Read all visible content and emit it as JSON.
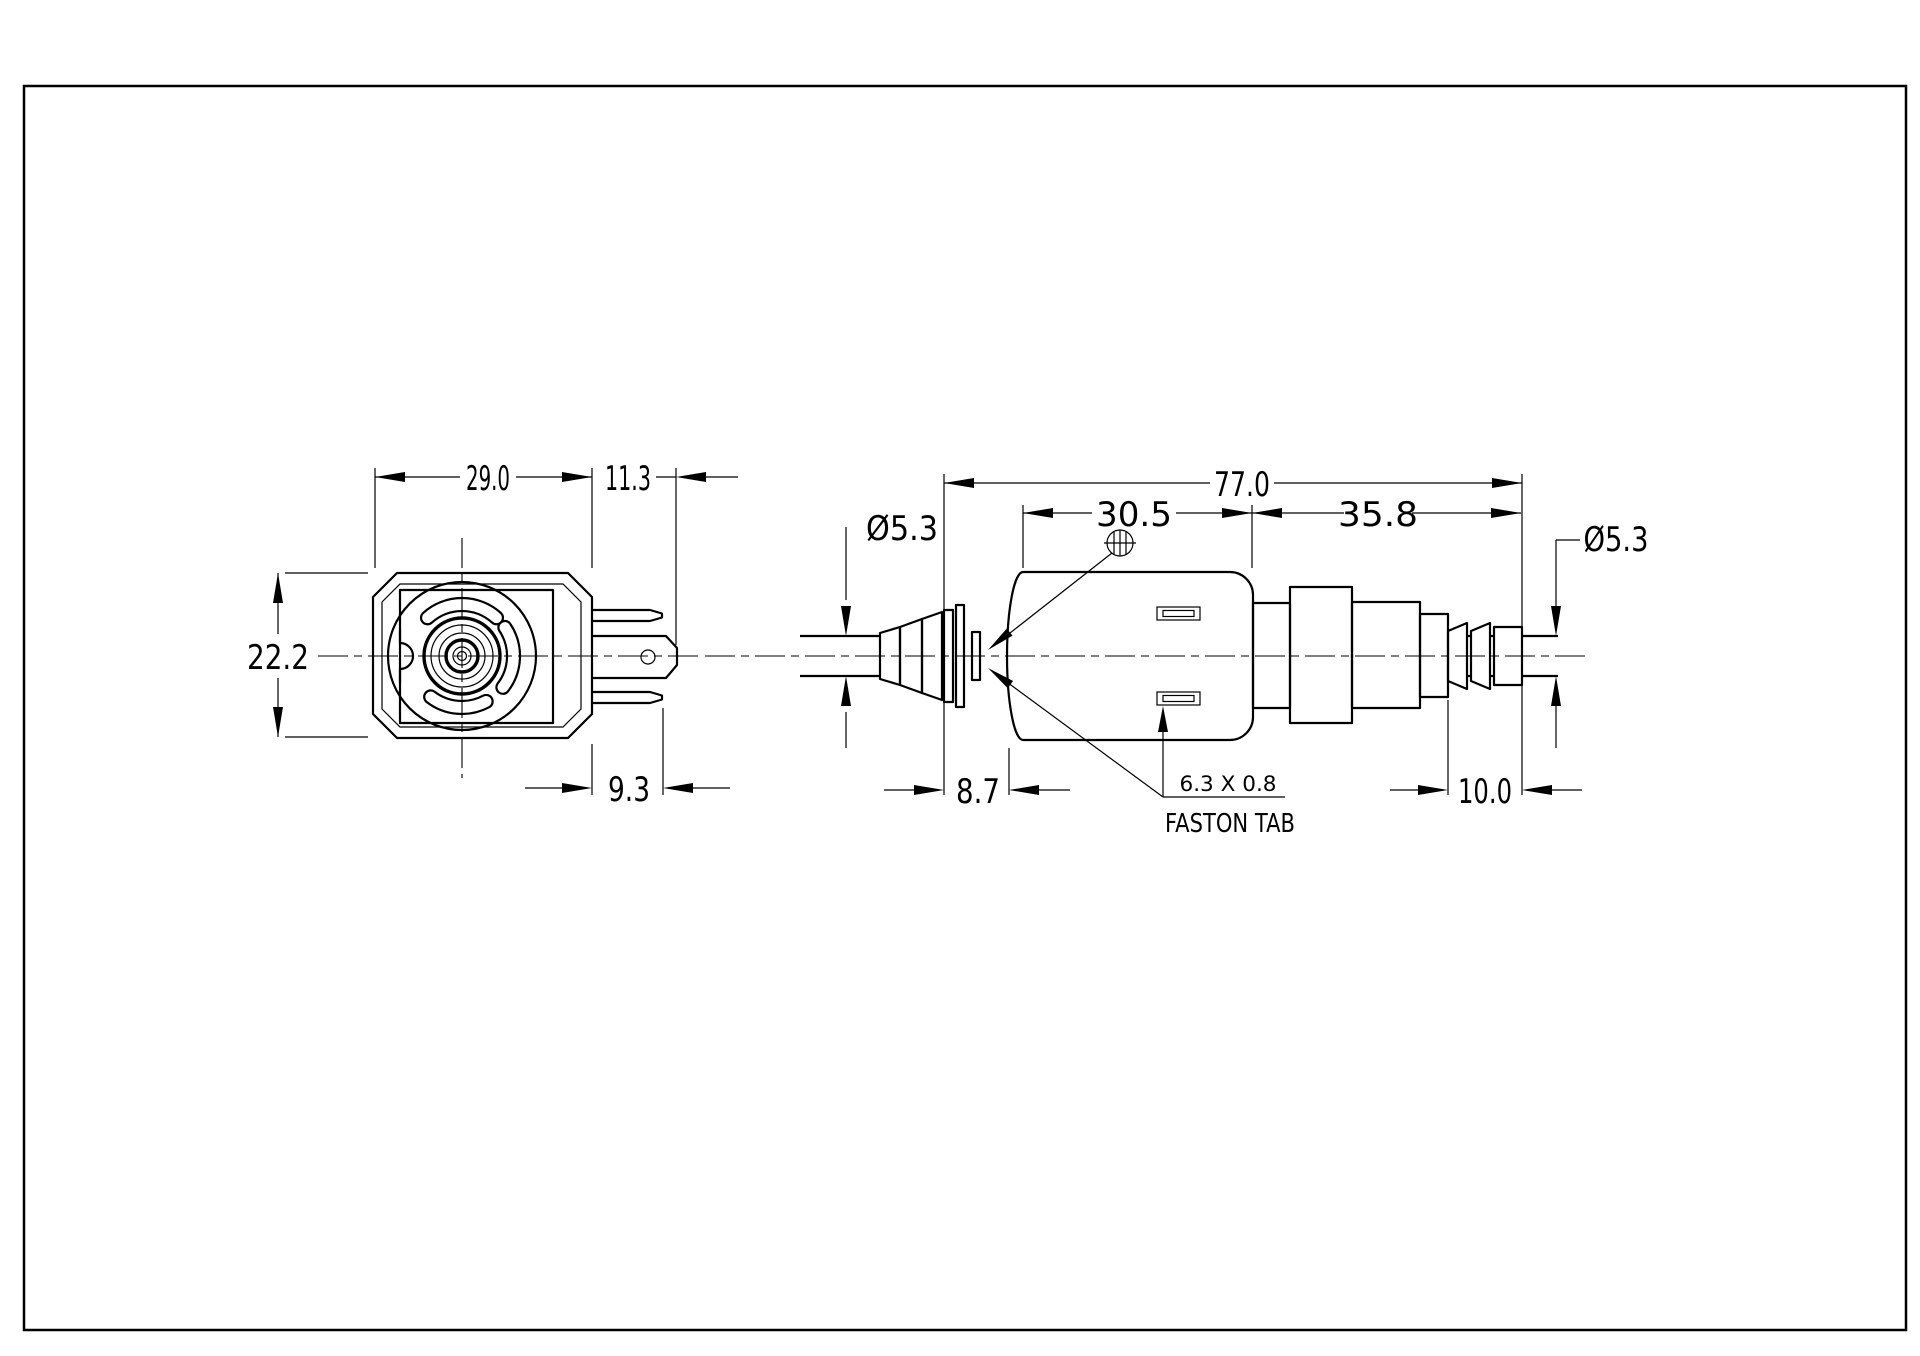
{
  "page": {
    "background": "#ffffff",
    "line_color": "#000000",
    "type": "technical-drawing"
  },
  "views": {
    "front": {
      "dims": {
        "coil_width": "29.0",
        "pin_long": "11.3",
        "body_height": "22.2",
        "pin_short": "9.3"
      }
    },
    "side": {
      "dims": {
        "overall_length": "77.0",
        "body_length": "30.5",
        "outlet_length": "35.8",
        "inlet_tube_dia": "Ø5.3",
        "outlet_tube_dia": "Ø5.3",
        "inlet_protrusion": "8.7",
        "outlet_barb_length": "10.0",
        "tab_size": "6.3 X 0.8"
      },
      "labels": {
        "faston_tab": "FASTON TAB"
      }
    }
  }
}
